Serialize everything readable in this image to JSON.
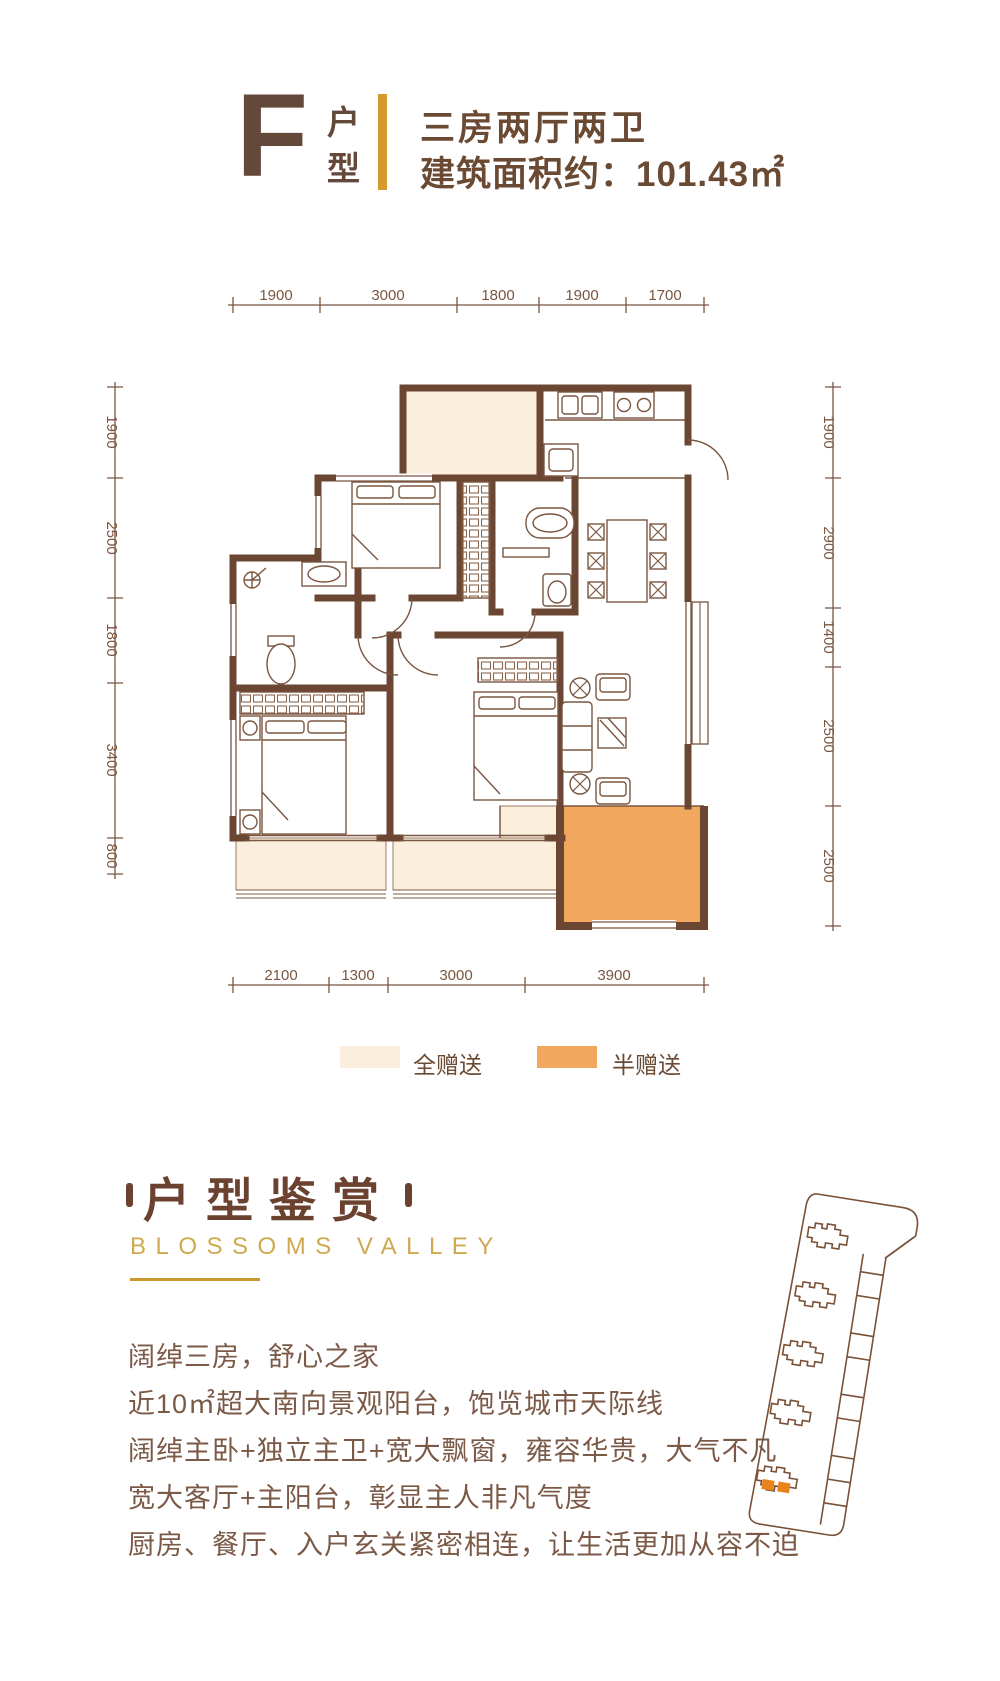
{
  "header": {
    "unit_letter": "F",
    "unit_label": "户型",
    "rooms": "三房两厅两卫",
    "area_label": "建筑面积约：",
    "area_value": "101.43㎡"
  },
  "dimensions": {
    "top": [
      "1900",
      "3000",
      "1800",
      "1900",
      "1700"
    ],
    "left": [
      "1900",
      "2500",
      "1800",
      "3400",
      "800"
    ],
    "right": [
      "1900",
      "2900",
      "1400",
      "2500",
      "2500"
    ],
    "bottom": [
      "2100",
      "1300",
      "3000",
      "3900"
    ]
  },
  "legend": {
    "full_gift": "全赠送",
    "half_gift": "半赠送"
  },
  "section": {
    "title": "户型鉴赏",
    "subtitle": "BLOSSOMS VALLEY"
  },
  "features": [
    "阔绰三房，舒心之家",
    "近10㎡超大南向景观阳台，饱览城市天际线",
    "阔绰主卧+独立主卫+宽大飘窗，雍容华贵，大气不凡",
    "宽大客厅+主阳台，彰显主人非凡气度",
    "厨房、餐厅、入户玄关紧密相连，让生活更加从容不迫"
  ],
  "colors": {
    "wall_brown": "#6b4733",
    "line_brown": "#7a5640",
    "accent_gold": "#d6992e",
    "title_gold": "#cfa94f",
    "full_gift_fill": "#fbeedd",
    "half_gift_fill": "#f2a75e",
    "highlight_orange": "#e8831d",
    "text_brown": "#7b5947"
  }
}
